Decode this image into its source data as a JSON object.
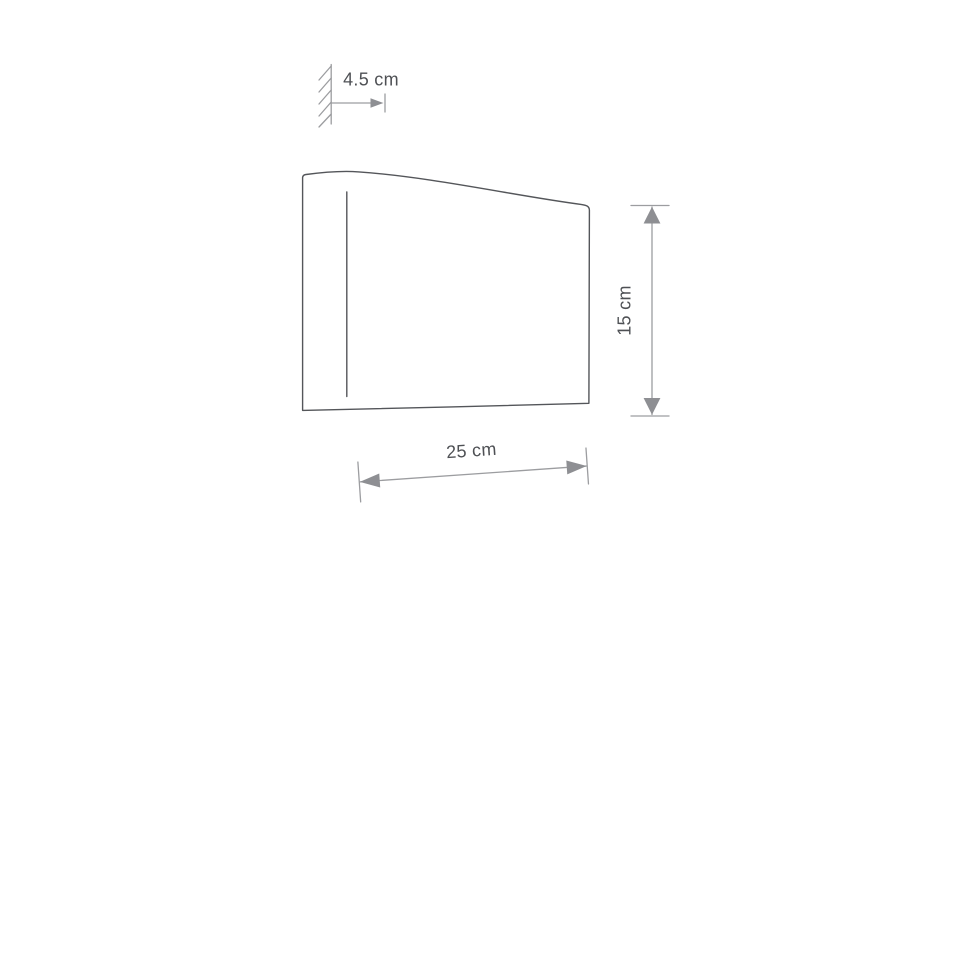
{
  "page": {
    "background": "#ffffff"
  },
  "drawing": {
    "labels": {
      "depth": "4.5 cm",
      "height": "15 cm",
      "width": "25 cm"
    },
    "measurements": [
      {
        "name": "depth",
        "value": 4.5,
        "unit": "cm"
      },
      {
        "name": "height",
        "value": 15,
        "unit": "cm"
      },
      {
        "name": "width",
        "value": 25,
        "unit": "cm"
      }
    ],
    "colors": {
      "outline": "#54565a",
      "dimension_lines": "#9c9da0",
      "arrowheads": "#8e8f93",
      "label_text": "#4e5054",
      "background": "#ffffff"
    }
  }
}
